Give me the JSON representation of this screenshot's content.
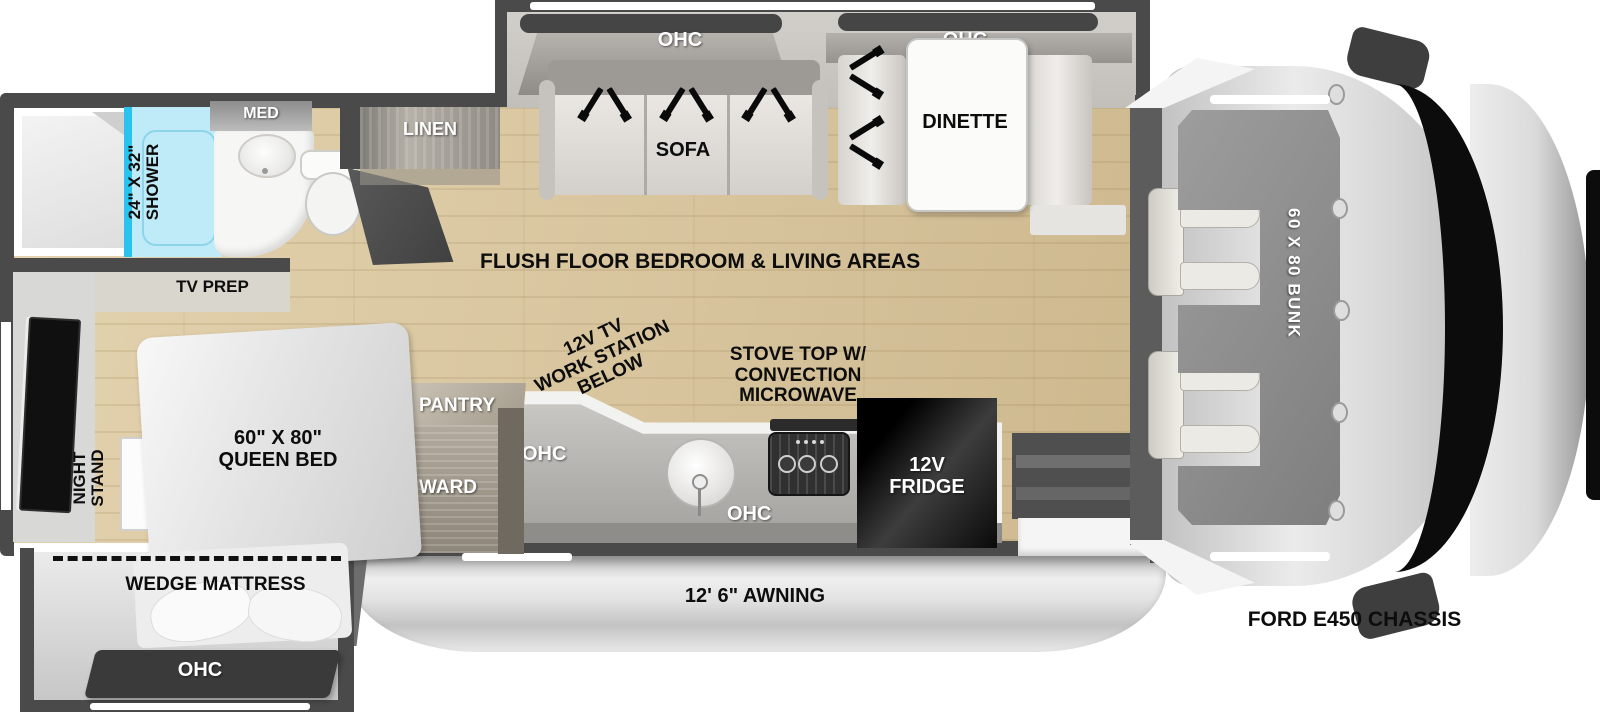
{
  "colors": {
    "wall": "#4a4a4a",
    "floor_wood": "#d8c59e",
    "shower_fill": "#bfeaf7",
    "shower_accent": "#29c3ee",
    "fridge_black": "#0d0d0d",
    "awning_gray": "#d9d9d9",
    "cab_glass": "#0c0c0c"
  },
  "labels": {
    "med": "MED",
    "shower_size": "24\" X 32\"",
    "shower_name": "SHOWER",
    "linen": "LINEN",
    "tv_prep": "TV PREP",
    "ohc_sofa": "OHC",
    "sofa": "SOFA",
    "ohc_dinette": "OHC",
    "dinette": "DINETTE",
    "flush_floor": "FLUSH FLOOR BEDROOM & LIVING AREAS",
    "work_station": [
      "12V TV",
      "WORK STATION",
      "BELOW"
    ],
    "stove": [
      "STOVE TOP W/",
      "CONVECTION",
      "MICROWAVE"
    ],
    "ohc_kitchen_left": "OHC",
    "ohc_kitchen_right": "OHC",
    "fridge": [
      "12V",
      "FRIDGE"
    ],
    "pantry": "PANTRY",
    "ward": "WARD",
    "night_stand": [
      "NIGHT",
      "STAND"
    ],
    "queen_bed": [
      "60\" X 80\"",
      "QUEEN BED"
    ],
    "wedge_mattress": "WEDGE MATTRESS",
    "ohc_wedge": "OHC",
    "bunk": "60 X 80 BUNK",
    "awning": "12' 6\" AWNING",
    "chassis": "FORD E450 CHASSIS"
  }
}
